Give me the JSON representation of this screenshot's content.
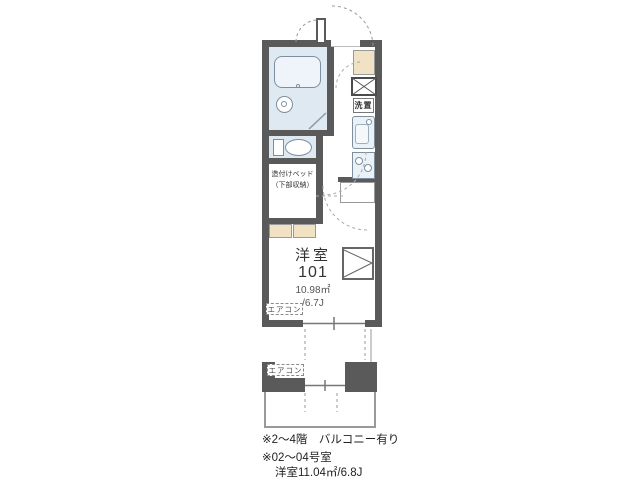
{
  "floorplan": {
    "room": {
      "type_label": "洋室",
      "number": "101",
      "area": "10.98㎡",
      "tatami": "/6.7J"
    },
    "labels": {
      "washer_storage": "洗置",
      "built_in_bed_line1": "造付けベッド",
      "built_in_bed_line2": "（下部収納）",
      "aircon_upper": "エアコン",
      "aircon_lower": "エアコン"
    },
    "notes": {
      "line1": "※2〜4階　バルコニー有り",
      "line2": "※02〜04号室",
      "line3": "洋室11.04㎡/6.8J"
    },
    "colors": {
      "wall": "#5a5a5a",
      "water_area": "#dfe9f2",
      "fixture_fill": "#eaf1f7",
      "cabinet_tan": "#f1e2c3"
    }
  }
}
